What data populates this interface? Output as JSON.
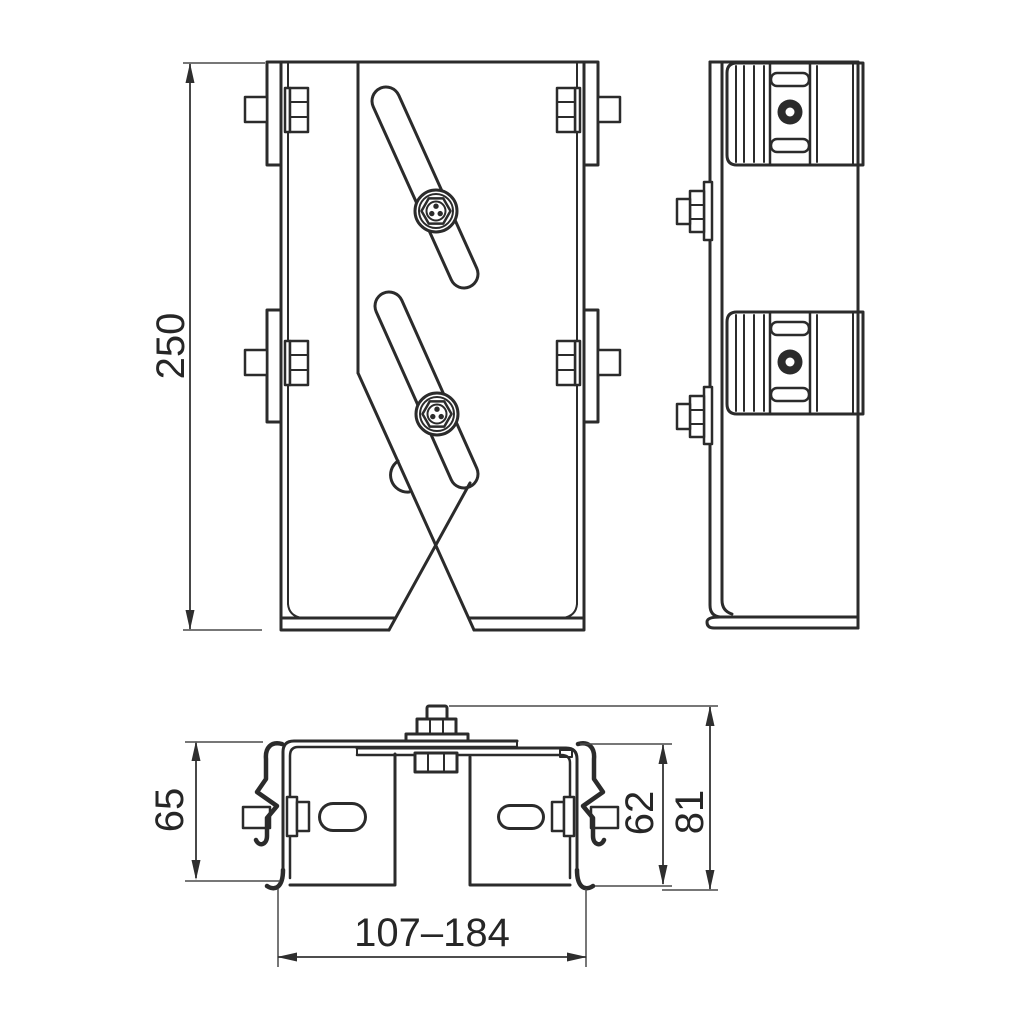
{
  "drawing": {
    "line_color": "#2b2b2b",
    "dimension_color": "#343434",
    "background": "#ffffff",
    "dimensions": {
      "height": {
        "label": "250"
      },
      "depth": {
        "label": "65"
      },
      "inner_height": {
        "label": "62"
      },
      "outer_height": {
        "label": "81"
      },
      "width_range": {
        "label": "107–184"
      }
    }
  }
}
